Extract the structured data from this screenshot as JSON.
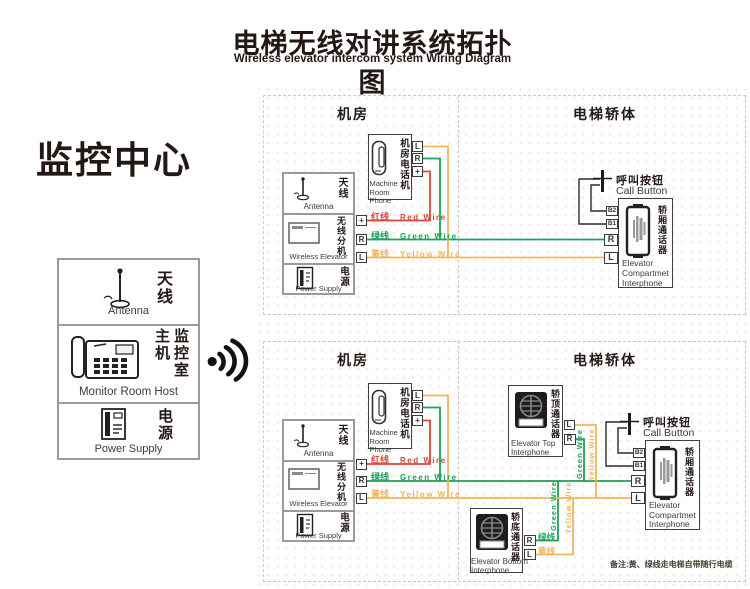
{
  "colors": {
    "red": "#d9463c",
    "green": "#1ba158",
    "yellow": "#f2b45c",
    "ink": "#231815",
    "note": "#454036"
  },
  "header": {
    "title_zh": "电梯无线对讲系统拓扑图",
    "title_en": "Wireless elevator intercom system Wiring Diagram"
  },
  "monitor": {
    "title": "监控中心",
    "antenna_zh": "天线",
    "antenna_en": "Antenna",
    "host_zh": "监控室主机",
    "host_en": "Monitor Room Host",
    "power_zh": "电源",
    "power_en": "Power Supply"
  },
  "labels": {
    "room": "机房",
    "car": "电梯轿体",
    "phone_zh": "机房电话机",
    "phone_en_1": "Machine",
    "phone_en_2": "Room Phone",
    "unit_antenna_zh": "天线",
    "unit_antenna_en": "Antenna",
    "unit_wireless_zh": "无线分机",
    "unit_wireless_en": "Wireless Elevator",
    "unit_power_zh": "电源",
    "unit_power_en": "Power Supply",
    "red_zh": "红线",
    "red_en": "Red Wire",
    "green_zh": "绿线",
    "green_en": "Green Wire",
    "yellow_zh": "黄线",
    "yellow_en": "Yellow Wire",
    "call_zh": "呼叫按钮",
    "call_en": "Call Button",
    "compartment_zh": "轿厢通话器",
    "compartment_en_1": "Elevator",
    "compartment_en_2": "Compartmet",
    "compartment_en_3": "Interphone",
    "terminal_L": "L",
    "terminal_R": "R",
    "terminal_plus": "+",
    "terminal_B2": "B2",
    "terminal_B1": "B1"
  },
  "bottom": {
    "top_interphone_zh": "轿顶通话器",
    "top_interphone_en_1": "Elevator Top",
    "top_interphone_en_2": "Interphone",
    "bottom_interphone_zh": "轿底通话器",
    "bottom_interphone_en_1": "Elevator Bottom",
    "bottom_interphone_en_2": "Interphone",
    "v_green": "Green Wire",
    "v_yellow": "Yellow Wire",
    "note": "备注:黄、绿线走电梯自带随行电缆"
  }
}
